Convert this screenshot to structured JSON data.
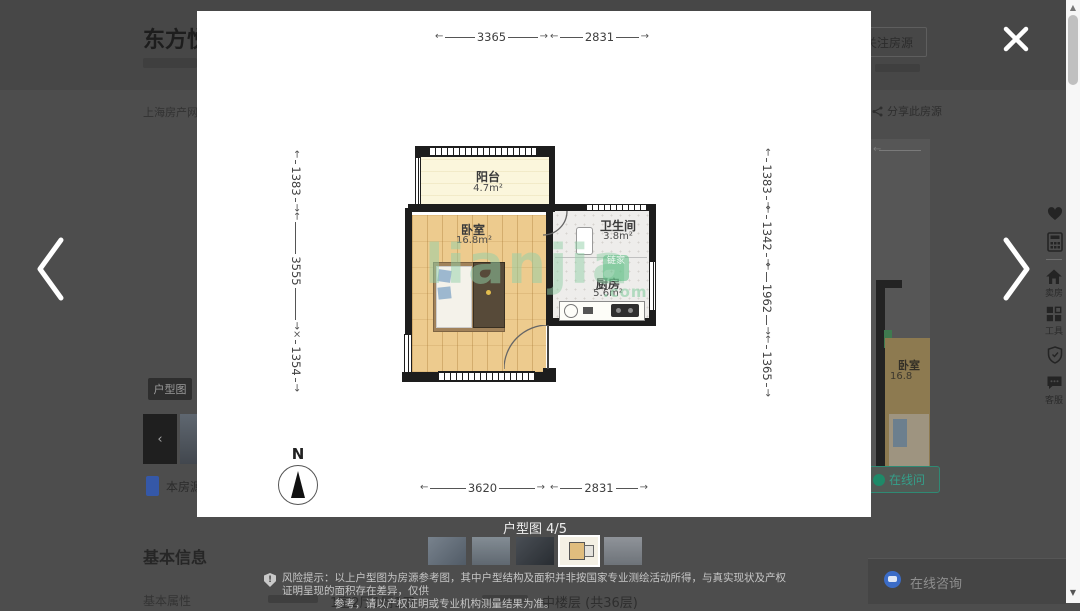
{
  "page": {
    "title": "东方悦",
    "breadcrumb": "上海房产网",
    "follow_button": "关注房源",
    "share_button": "分享此房源",
    "floorplan_tag": "户型图",
    "this_listing_label": "本房源",
    "basic_info_heading": "基本信息",
    "basic_attr_label": "基本属性",
    "layout_value": "1室2厅1厨1卫",
    "floor_value": "中楼层 (共36层)",
    "chat_button_label": "在线咨询",
    "online_ask_label": "在线问",
    "bg_room_name": "卧室",
    "bg_room_area": "16.8"
  },
  "lightbox": {
    "caption": "户型图 4/5",
    "risk_label": "风险提示：",
    "risk_line1": "以上户型图为房源参考图，其中户型结构及面积并非按国家专业测绘活动所得，与真实现状及产权证明呈现的面积存在差异，仅供",
    "risk_line2": "参考，请以产权证明或专业机构测量结果为准。"
  },
  "floorplan": {
    "compass_label": "N",
    "watermark_main": "lianjia",
    "watermark_logo": "链家",
    "watermark_suffix": ".com",
    "dims_top": [
      "3365",
      "2831"
    ],
    "dims_bottom": [
      "3620",
      "2831"
    ],
    "dims_left": [
      "1383",
      "3555",
      "1354"
    ],
    "dims_right": [
      "1383",
      "1342",
      "1962",
      "1365"
    ],
    "rooms": {
      "balcony": {
        "name": "阳台",
        "area": "4.7m²"
      },
      "bedroom": {
        "name": "卧室",
        "area": "16.8m²"
      },
      "bathroom": {
        "name": "卫生间",
        "area": "3.8m²"
      },
      "kitchen": {
        "name": "厨房",
        "area": "5.6m²"
      }
    }
  },
  "sidebar": {
    "sell_label": "卖房",
    "tools_label": "工具",
    "service_label": "客服"
  },
  "colors": {
    "teal_accent": "#2f9e8a",
    "watermark_green": "#8cd2a6",
    "chat_blue": "#3b6cc7",
    "overlay_gray": "#4d4d4d"
  }
}
